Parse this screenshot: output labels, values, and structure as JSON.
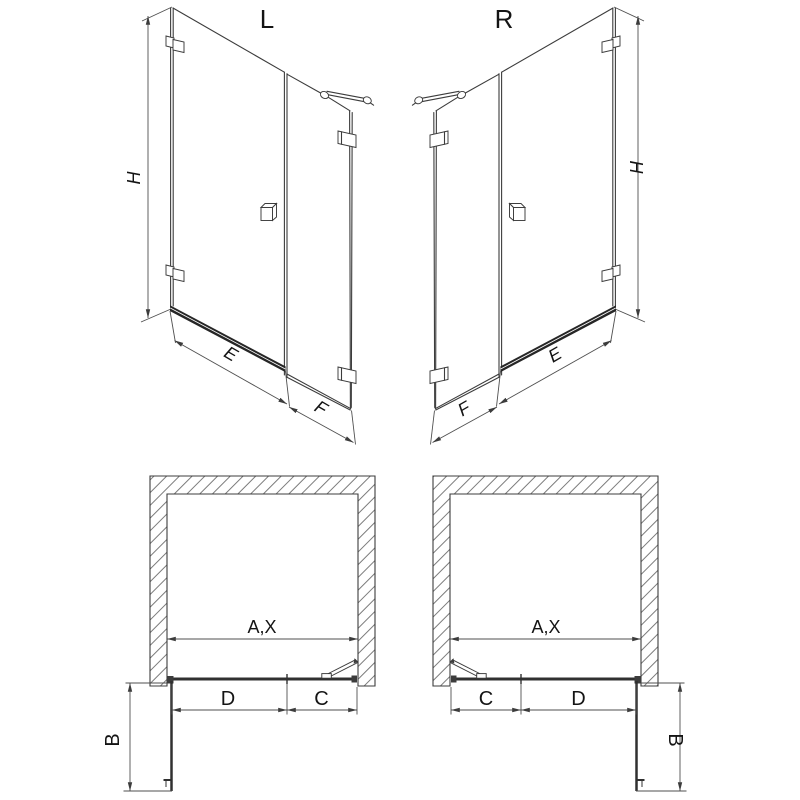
{
  "drawing": {
    "background": "#ffffff",
    "line_color": "#3c3c3c",
    "dim_color": "#4f4f4f",
    "text_color": "#141414",
    "views": {
      "front_left": {
        "variant_label": "L",
        "height_dim": "H",
        "door_dim": "E",
        "panel_dim": "F"
      },
      "front_right": {
        "variant_label": "R",
        "height_dim": "H",
        "door_dim": "E",
        "panel_dim": "F"
      },
      "plan_left": {
        "opening_dim": "A,X",
        "door_dim": "D",
        "panel_dim": "C",
        "swing_dim": "B"
      },
      "plan_right": {
        "opening_dim": "A,X",
        "door_dim": "D",
        "panel_dim": "C",
        "swing_dim": "B"
      }
    }
  }
}
